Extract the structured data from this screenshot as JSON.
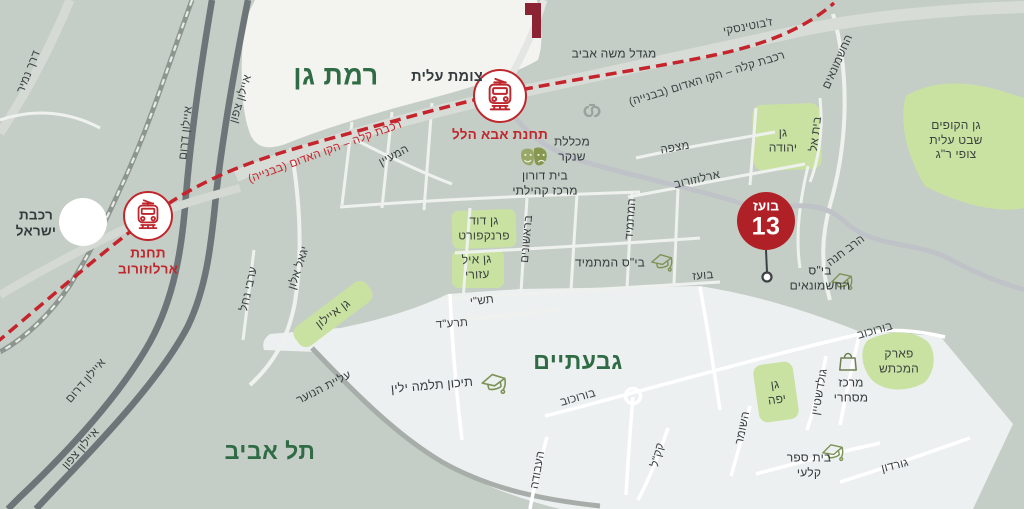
{
  "map": {
    "colors": {
      "base": "#c5cec6",
      "ramat_gan_area": "#f3f4ef",
      "urban_area": "#edf0f1",
      "park_green": "#c9e2a2",
      "road_dark": "#6e7578",
      "road_major": "#d8dcd7",
      "red_line": "#c5242c",
      "station_red": "#bf272e",
      "marker_red": "#b02127",
      "city_green": "#2f6b45",
      "label_dark": "#3b4144",
      "icon_green": "#7d9355"
    },
    "marker": {
      "street": "בועז",
      "number": "13"
    },
    "icons": [
      {
        "name": "train-station-icon",
        "meaning": "light rail station"
      },
      {
        "name": "theater-masks-icon",
        "meaning": "theater"
      },
      {
        "name": "graduation-cap-icon",
        "meaning": "school"
      },
      {
        "name": "shopping-bag-icon",
        "meaning": "commercial center"
      },
      {
        "name": "college-emblem-icon",
        "meaning": "college"
      },
      {
        "name": "brand-mark",
        "meaning": "red logo fragment"
      }
    ],
    "labels": [
      {
        "id": "derech-namir",
        "text": "דרך נמיר",
        "x": 29,
        "y": 72,
        "rot": -68,
        "cls": "street"
      },
      {
        "id": "ayalon-darom-north",
        "text": "איילון דרום",
        "x": 186,
        "y": 133,
        "rot": -84,
        "cls": "street"
      },
      {
        "id": "ayalon-tzafon-north",
        "text": "איילון צפון",
        "x": 241,
        "y": 99,
        "rot": -73,
        "cls": "street"
      },
      {
        "id": "red-line-west",
        "text": "רכבת קלה – הקו האדום (בבנייה)",
        "x": 325,
        "y": 152,
        "rot": -20,
        "cls": "redline"
      },
      {
        "id": "ramat-gan",
        "text": "רמת גן",
        "x": 336,
        "y": 76,
        "rot": 0,
        "cls": "city",
        "fs": 27
      },
      {
        "id": "tzomet-alit",
        "text": "צומת עלית",
        "x": 447,
        "y": 78,
        "rot": 0,
        "cls": "place-bold",
        "fs": 14.5
      },
      {
        "id": "migdal-moshe-aviv",
        "text": "מגדל משה אביב",
        "x": 614,
        "y": 54,
        "rot": 0,
        "cls": "place"
      },
      {
        "id": "jabotinsky",
        "text": "ז'בוטינסקי",
        "x": 748,
        "y": 27,
        "rot": -11,
        "cls": "street"
      },
      {
        "id": "red-line-east",
        "text": "רכבת קלה – הקו האדום (בבנייה)",
        "x": 707,
        "y": 79,
        "rot": -17,
        "cls": "street"
      },
      {
        "id": "hashmonaim-road",
        "text": "החשמונאים",
        "x": 838,
        "y": 62,
        "rot": -66,
        "cls": "street"
      },
      {
        "id": "gan-hakofim",
        "text": "גן הקופים\nשבט עלית\nצופי ר\"ג",
        "x": 956,
        "y": 140,
        "rot": 0,
        "cls": "park"
      },
      {
        "id": "michlelet-shenkar",
        "text": "מכללת\nשנקר",
        "x": 572,
        "y": 149,
        "rot": 0,
        "cls": "place"
      },
      {
        "id": "beit-doron",
        "text": "בית דורון\nמרכז קהילתי",
        "x": 545,
        "y": 183,
        "rot": 0,
        "cls": "place"
      },
      {
        "id": "hamaayan",
        "text": "המעיין",
        "x": 394,
        "y": 156,
        "rot": -28,
        "cls": "street"
      },
      {
        "id": "mitzpe",
        "text": "מצפה",
        "x": 675,
        "y": 148,
        "rot": -10,
        "cls": "street"
      },
      {
        "id": "arlozorov-street",
        "text": "ארלוזורוב",
        "x": 697,
        "y": 180,
        "rot": -13,
        "cls": "street"
      },
      {
        "id": "gan-yehuda",
        "text": "גן\nיהודה",
        "x": 783,
        "y": 140,
        "rot": 0,
        "cls": "park"
      },
      {
        "id": "beit-el",
        "text": "בית אל",
        "x": 816,
        "y": 134,
        "rot": -83,
        "cls": "street"
      },
      {
        "id": "rakevet-israel",
        "text": "רכבת\nישראל",
        "x": 36,
        "y": 224,
        "rot": 0,
        "cls": "place-bold",
        "fs": 13.5
      },
      {
        "id": "arvei-nahal",
        "text": "ערבי נחל",
        "x": 249,
        "y": 289,
        "rot": -77,
        "cls": "street"
      },
      {
        "id": "yigal-alon",
        "text": "יגאל אלון",
        "x": 299,
        "y": 268,
        "rot": -72,
        "cls": "street"
      },
      {
        "id": "gan-ayalon",
        "text": "גן איילון",
        "x": 333,
        "y": 314,
        "rot": -37,
        "cls": "park"
      },
      {
        "id": "barishonim",
        "text": "בראשונים",
        "x": 527,
        "y": 239,
        "rot": -85,
        "cls": "street"
      },
      {
        "id": "gan-david-frankfurt",
        "text": "גן דוד\nפרנקפורט",
        "x": 484,
        "y": 228,
        "rot": 0,
        "cls": "park"
      },
      {
        "id": "gan-eyal-azuri",
        "text": "גן איל\nעזורי",
        "x": 477,
        "y": 267,
        "rot": -3,
        "cls": "park"
      },
      {
        "id": "tashi",
        "text": "תש\"י",
        "x": 482,
        "y": 301,
        "rot": -7,
        "cls": "street"
      },
      {
        "id": "tarad",
        "text": "תרע\"ד",
        "x": 452,
        "y": 324,
        "rot": -4,
        "cls": "street"
      },
      {
        "id": "hamatmid-road",
        "text": "המתמיד",
        "x": 631,
        "y": 219,
        "rot": -86,
        "cls": "street"
      },
      {
        "id": "bis-hamatmid",
        "text": "בי\"ס המתמיד",
        "x": 610,
        "y": 263,
        "rot": 0,
        "cls": "place"
      },
      {
        "id": "boaz-street",
        "text": "בועז",
        "x": 703,
        "y": 276,
        "rot": -5,
        "cls": "street"
      },
      {
        "id": "bis-hashmonaim",
        "text": "בי\"ס\nהחשמונאים",
        "x": 820,
        "y": 278,
        "rot": 0,
        "cls": "place"
      },
      {
        "id": "harav-hana",
        "text": "הרב חנה",
        "x": 846,
        "y": 251,
        "rot": -37,
        "cls": "street"
      },
      {
        "id": "borochov-east",
        "text": "בורוכוב",
        "x": 875,
        "y": 331,
        "rot": -16,
        "cls": "street"
      },
      {
        "id": "park-hamachtesh",
        "text": "פארק\nהמכתש",
        "x": 899,
        "y": 361,
        "rot": 0,
        "cls": "park"
      },
      {
        "id": "merkaz-mishari",
        "text": "מרכז\nמסחרי",
        "x": 851,
        "y": 390,
        "rot": 0,
        "cls": "place"
      },
      {
        "id": "gordon",
        "text": "גורדון",
        "x": 895,
        "y": 466,
        "rot": -14,
        "cls": "street"
      },
      {
        "id": "beit-sefer-kalai",
        "text": "בית ספר\nקלעי",
        "x": 809,
        "y": 465,
        "rot": 0,
        "cls": "place"
      },
      {
        "id": "kakal",
        "text": "קק\"ל",
        "x": 658,
        "y": 455,
        "rot": -76,
        "cls": "street"
      },
      {
        "id": "hashomer",
        "text": "השומר",
        "x": 743,
        "y": 428,
        "rot": -78,
        "cls": "street"
      },
      {
        "id": "goldstein",
        "text": "גולדשטיין",
        "x": 820,
        "y": 392,
        "rot": -80,
        "cls": "street"
      },
      {
        "id": "gan-yafe",
        "text": "גן\nיפה",
        "x": 776,
        "y": 392,
        "rot": -8,
        "cls": "park"
      },
      {
        "id": "borochov-west",
        "text": "בורוכוב",
        "x": 578,
        "y": 398,
        "rot": -16,
        "cls": "street"
      },
      {
        "id": "givatayim",
        "text": "גבעתיים",
        "x": 578,
        "y": 361,
        "rot": 0,
        "cls": "city",
        "fs": 23
      },
      {
        "id": "tichon-thelma-yellin",
        "text": "תיכון תלמה ילין",
        "x": 432,
        "y": 386,
        "rot": -5,
        "cls": "place",
        "fs": 12.5
      },
      {
        "id": "haavoda",
        "text": "העבודה",
        "x": 538,
        "y": 470,
        "rot": -80,
        "cls": "street"
      },
      {
        "id": "aliyat-hanoar",
        "text": "עליית הנוער",
        "x": 324,
        "y": 388,
        "rot": -27,
        "cls": "street"
      },
      {
        "id": "tel-aviv",
        "text": "תל אביב",
        "x": 270,
        "y": 451,
        "rot": 0,
        "cls": "city",
        "fs": 23
      },
      {
        "id": "ayalon-darom-south",
        "text": "איילון דרום",
        "x": 86,
        "y": 381,
        "rot": -49,
        "cls": "street"
      },
      {
        "id": "ayalon-tzafon-south",
        "text": "איילון צפון",
        "x": 81,
        "y": 449,
        "rot": -49,
        "cls": "street"
      },
      {
        "id": "station-aba-hillel",
        "text": "תחנת אבא הלל",
        "x": 500,
        "y": 135,
        "rot": 0,
        "cls": "station"
      },
      {
        "id": "station-arlozorov",
        "text": "תחנת\nארלוזורוב",
        "x": 148,
        "y": 262,
        "rot": 0,
        "cls": "station"
      }
    ]
  }
}
